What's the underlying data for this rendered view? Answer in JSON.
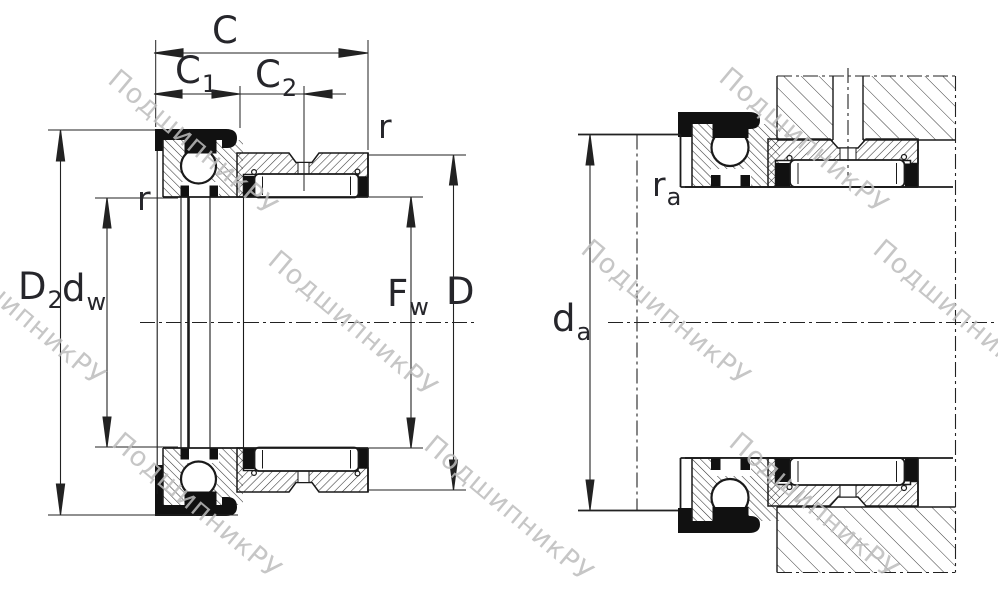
{
  "drawing": {
    "watermark_text": "ПодшипникРУ",
    "colors": {
      "line": "#1a1a1a",
      "dimension": "#222222",
      "label": "#26262b",
      "watermark": "#bdbdbd",
      "background": "#ffffff"
    },
    "dimension_labels": {
      "C": {
        "main": "C",
        "sub": ""
      },
      "C1": {
        "main": "C",
        "sub": "1"
      },
      "C2": {
        "main": "C",
        "sub": "2"
      },
      "D2": {
        "main": "D",
        "sub": "2"
      },
      "dw": {
        "main": "d",
        "sub": "w"
      },
      "Fw": {
        "main": "F",
        "sub": "w"
      },
      "D": {
        "main": "D",
        "sub": ""
      },
      "r_inner": {
        "main": "r",
        "sub": ""
      },
      "r_outer": {
        "main": "r",
        "sub": ""
      },
      "da": {
        "main": "d",
        "sub": "a"
      },
      "ra": {
        "main": "r",
        "sub": "a"
      }
    }
  }
}
